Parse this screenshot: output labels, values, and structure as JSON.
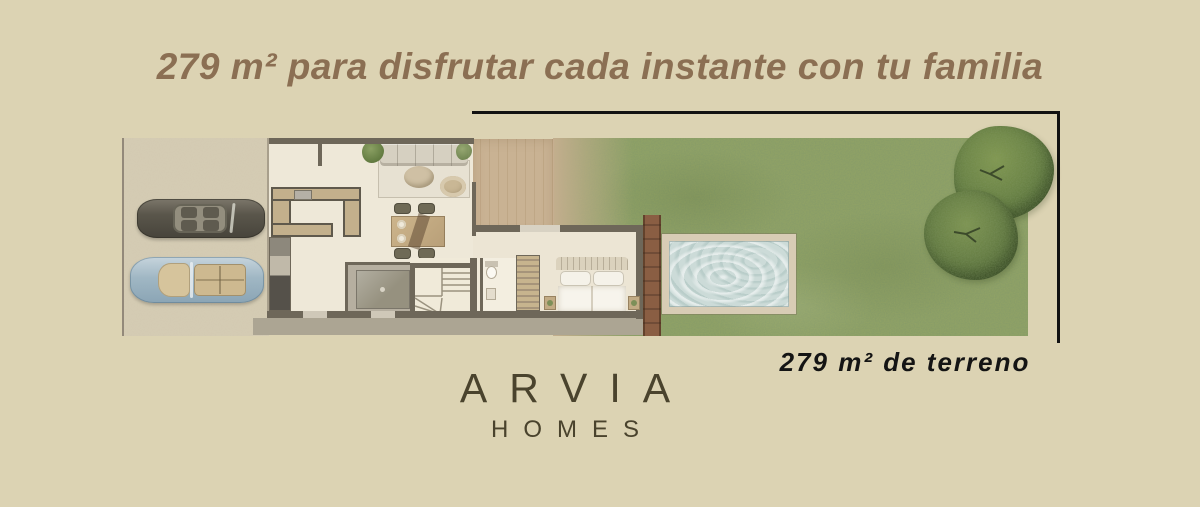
{
  "header": {
    "title": "279 m² para disfrutar cada instante con tu familia"
  },
  "caption": {
    "terrain": "279 m² de terreno"
  },
  "brand": {
    "name": "ARVIA",
    "subtitle": "HOMES"
  },
  "colors": {
    "background": "#dcd3b3",
    "title_text": "#8b6f53",
    "caption_text": "#141414",
    "brand_text": "#4a432d",
    "frame_line": "#121212",
    "lawn_green": "#93a465",
    "pool_water": "#ccdbd8",
    "pool_deck": "#d8ccb5",
    "timber_screen": "#84593f",
    "deck_wood": "#c6af90",
    "wall": "#6e6759",
    "house_floor": "#ece5d5",
    "driveway": "#d6cdb4",
    "car_dark": "#55514a",
    "car_blue": "#a8bcc9",
    "tree_green": "#5f783e"
  },
  "floor_plan": {
    "features": [
      "driveway",
      "car-dark",
      "car-blue",
      "kitchen",
      "appliances",
      "living-room",
      "sofa",
      "dining-table",
      "stairs",
      "bathroom",
      "utility-room",
      "wardrobe",
      "bedroom",
      "bed",
      "wood-deck",
      "timber-screen",
      "pool",
      "lawn",
      "tree",
      "sidewalk"
    ]
  }
}
